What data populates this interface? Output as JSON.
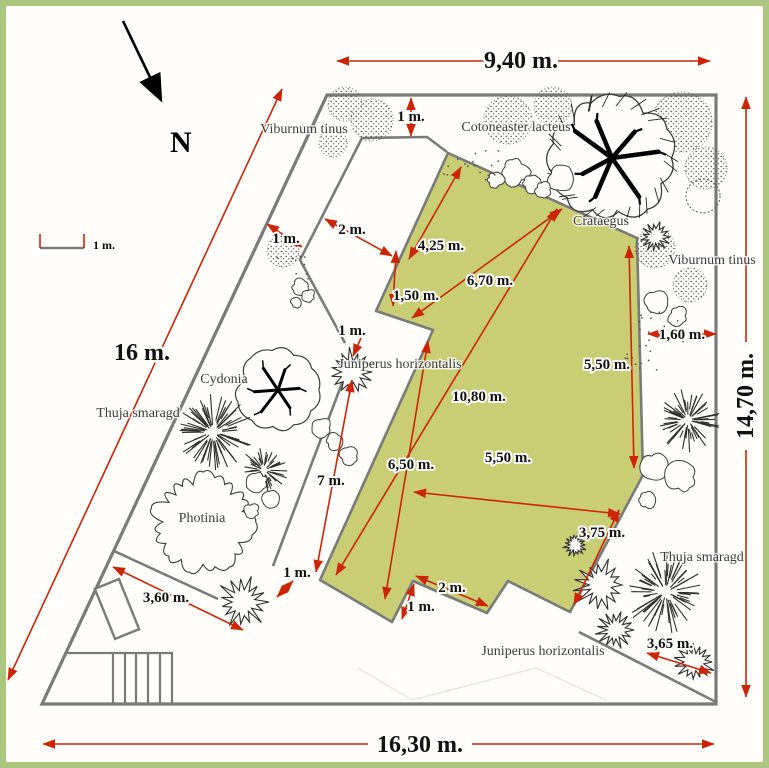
{
  "compass": {
    "label": "N"
  },
  "scale": {
    "label": "1 m."
  },
  "site_dimensions": {
    "top": "9,40 m.",
    "right": "14,70 m.",
    "bottom": "16,30 m.",
    "left": "16 m."
  },
  "measurements": [
    {
      "id": "top-border-offset",
      "label": "1 m."
    },
    {
      "id": "left-corridor-width",
      "label": "1 m."
    },
    {
      "id": "upper-path-width",
      "label": "2 m."
    },
    {
      "id": "lawn-top-edge",
      "label": "4,25 m."
    },
    {
      "id": "lawn-step",
      "label": "1,50 m."
    },
    {
      "id": "lawn-diagonal-upper",
      "label": "6,70 m."
    },
    {
      "id": "path-narrow-width",
      "label": "1 m."
    },
    {
      "id": "lawn-length",
      "label": "10,80 m."
    },
    {
      "id": "lawn-right-edge",
      "label": "5,50 m."
    },
    {
      "id": "right-strip-width",
      "label": "1,60 m."
    },
    {
      "id": "lawn-left-edge",
      "label": "6,50 m."
    },
    {
      "id": "lawn-diagonal-lower",
      "label": "5,50 m."
    },
    {
      "id": "side-path-length",
      "label": "7 m."
    },
    {
      "id": "lawn-lower-right-edge",
      "label": "3,75 m."
    },
    {
      "id": "bed-gap-width",
      "label": "1 m."
    },
    {
      "id": "bottom-path-length",
      "label": "3,60 m."
    },
    {
      "id": "lawn-notch-width",
      "label": "2 m."
    },
    {
      "id": "lawn-notch-depth",
      "label": "1 m."
    },
    {
      "id": "corner-hedge-length",
      "label": "3,65 m."
    }
  ],
  "plants": [
    {
      "id": "viburnum-top",
      "name": "Viburnum tinus"
    },
    {
      "id": "cotoneaster",
      "name": "Cotoneaster lacteus"
    },
    {
      "id": "crataegus",
      "name": "Crataegus"
    },
    {
      "id": "viburnum-right",
      "name": "Viburnum tinus"
    },
    {
      "id": "cydonia",
      "name": "Cydonia"
    },
    {
      "id": "thuja-left",
      "name": "Thuja smaragd"
    },
    {
      "id": "juniperus-mid",
      "name": "Juniperus horizontalis"
    },
    {
      "id": "photinia",
      "name": "Photinia"
    },
    {
      "id": "thuja-right",
      "name": "Thuja smaragd"
    },
    {
      "id": "juniperus-bottom",
      "name": "Juniperus horizontalis"
    }
  ],
  "colors": {
    "lawn": "#c9cd74",
    "frame": "#abc77e",
    "dimension_red": "#cc2506",
    "boundary_grey": "#7a7a7a"
  }
}
